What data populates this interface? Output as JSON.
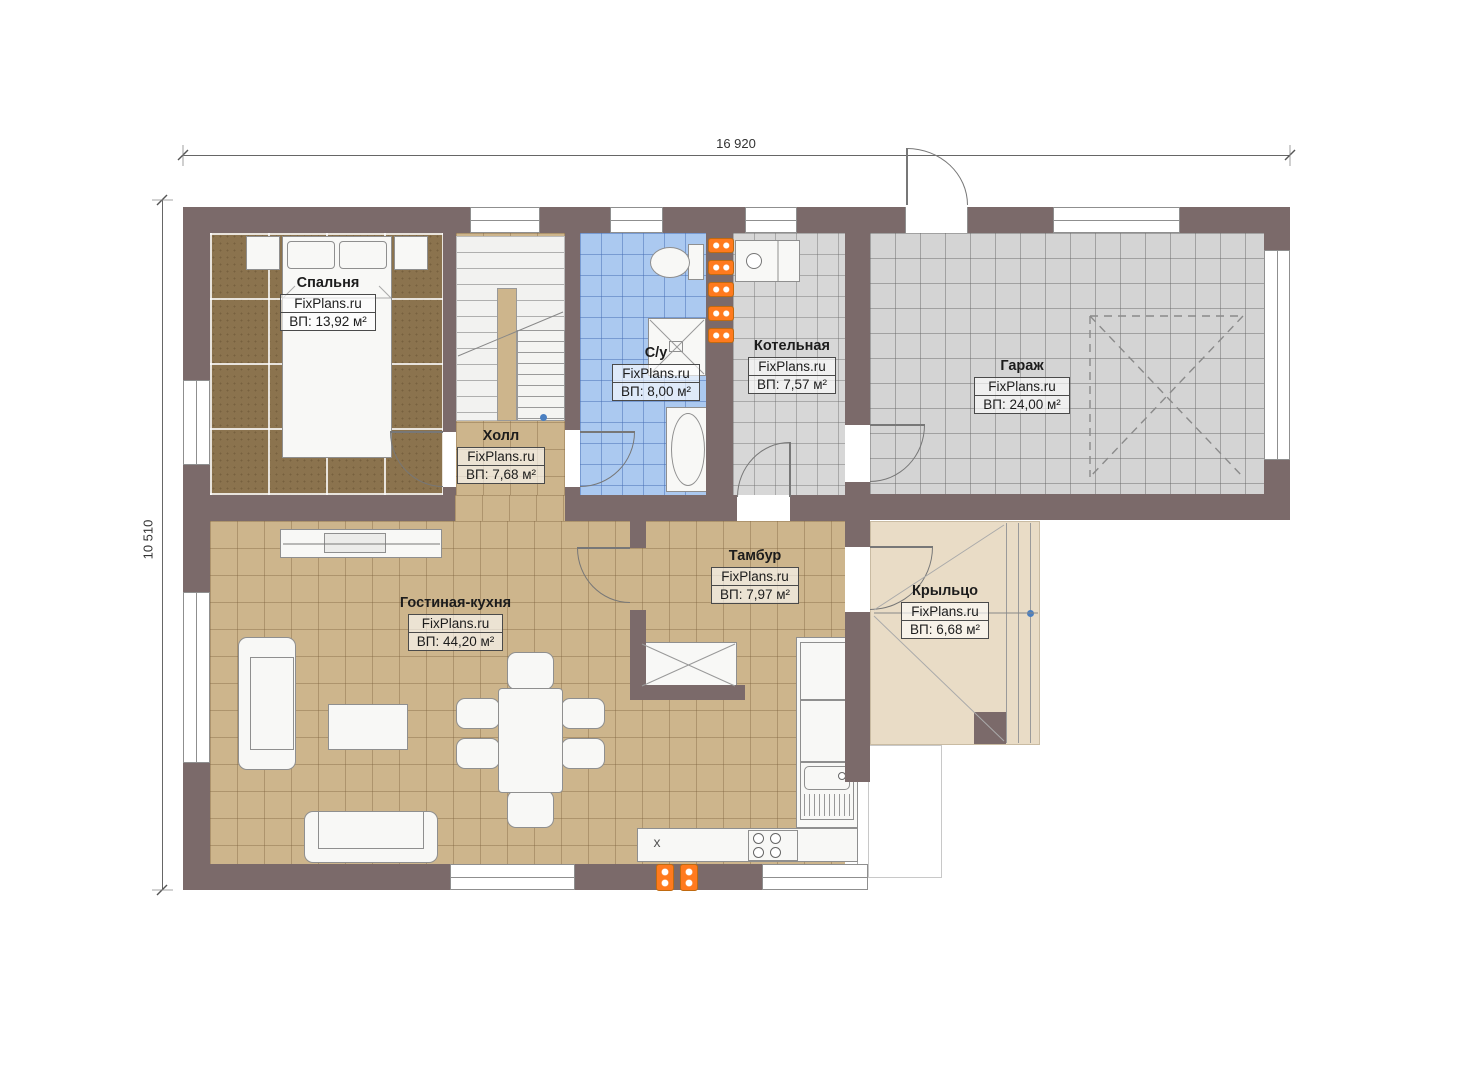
{
  "plan_title": "floor-plan",
  "dimensions": {
    "width_label": "16 920",
    "height_label": "10 510"
  },
  "rooms": [
    {
      "name": "Спальня",
      "brand": "FixPlans.ru",
      "area": "ВП: 13,92 м²"
    },
    {
      "name": "Холл",
      "brand": "FixPlans.ru",
      "area": "ВП: 7,68 м²"
    },
    {
      "name": "С/у",
      "brand": "FixPlans.ru",
      "area": "ВП: 8,00 м²"
    },
    {
      "name": "Котельная",
      "brand": "FixPlans.ru",
      "area": "ВП: 7,57 м²"
    },
    {
      "name": "Гараж",
      "brand": "FixPlans.ru",
      "area": "ВП: 24,00 м²"
    },
    {
      "name": "Гостиная-кухня",
      "brand": "FixPlans.ru",
      "area": "ВП: 44,20 м²"
    },
    {
      "name": "Тамбур",
      "brand": "FixPlans.ru",
      "area": "ВП: 7,97 м²"
    },
    {
      "name": "Крыльцо",
      "brand": "FixPlans.ru",
      "area": "ВП: 6,68 м²"
    }
  ],
  "kitchen": {
    "appliance_mark": "x"
  },
  "colors": {
    "wall": "#7b6a6a",
    "bedroom_floor": "#8b734e",
    "tan_floor": "#cdb58c",
    "bath_floor": "#abc9f0",
    "gray_floor": "#d7d7d7",
    "garage_floor": "#d4d4d4",
    "porch_floor": "#e9dcc6",
    "radiator": "#ff7a1e"
  }
}
